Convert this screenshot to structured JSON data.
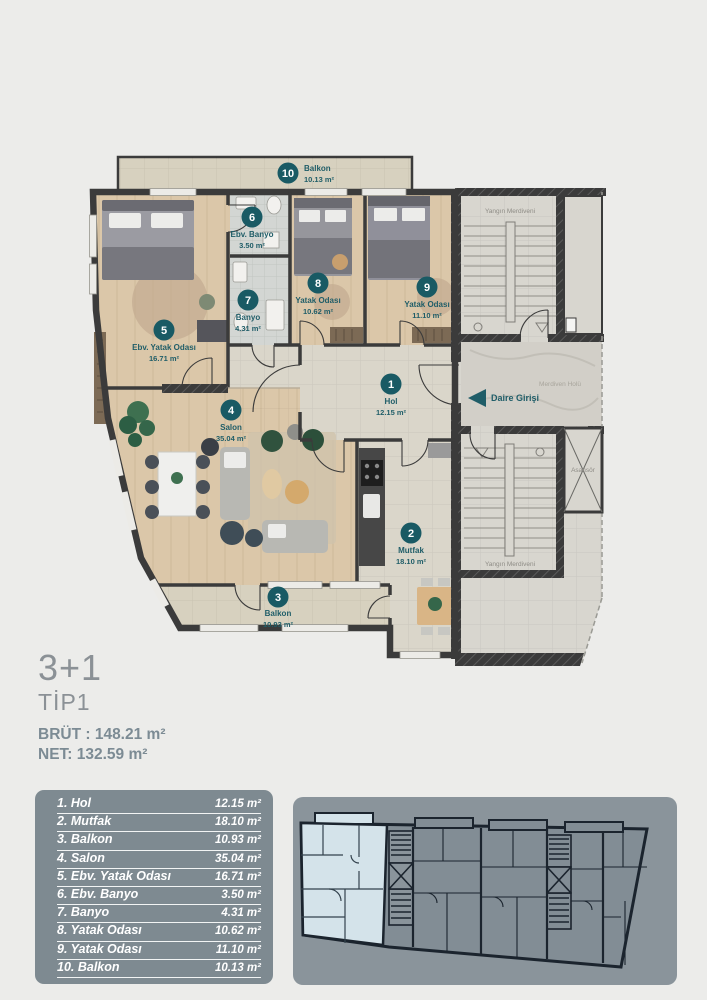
{
  "header": {
    "type_label": "3+1",
    "tip_label": "TİP1",
    "brut": "BRÜT : 148.21 m²",
    "net": "NET: 132.59 m²"
  },
  "floor_plan": {
    "rooms": [
      {
        "no": "1",
        "name": "Hol",
        "area": "12.15 m²"
      },
      {
        "no": "2",
        "name": "Mutfak",
        "area": "18.10 m²"
      },
      {
        "no": "3",
        "name": "Balkon",
        "area": "10.93 m²"
      },
      {
        "no": "4",
        "name": "Salon",
        "area": "35.04 m²"
      },
      {
        "no": "5",
        "name": "Ebv. Yatak Odası",
        "area": "16.71 m²"
      },
      {
        "no": "6",
        "name": "Ebv. Banyo",
        "area": "3.50 m²"
      },
      {
        "no": "7",
        "name": "Banyo",
        "area": "4.31 m²"
      },
      {
        "no": "8",
        "name": "Yatak Odası",
        "area": "10.62 m²"
      },
      {
        "no": "9",
        "name": "Yatak Odası",
        "area": "11.10 m²"
      },
      {
        "no": "10",
        "name": "Balkon",
        "area": "10.13 m²"
      }
    ],
    "annotations": {
      "fire_escape_top": "Yangın Merdiveni",
      "fire_escape_bottom": "Yangın Merdiveni",
      "stair_hall": "Merdiven Holü",
      "elevator": "Asansör",
      "entrance": "Daire Girişi"
    }
  },
  "area_table": {
    "rows": [
      {
        "label": "1. Hol",
        "value": "12.15 m²"
      },
      {
        "label": "2. Mutfak",
        "value": "18.10 m²"
      },
      {
        "label": "3. Balkon",
        "value": "10.93 m²"
      },
      {
        "label": "4. Salon",
        "value": "35.04 m²"
      },
      {
        "label": "5. Ebv. Yatak Odası",
        "value": "16.71 m²"
      },
      {
        "label": "6. Ebv. Banyo",
        "value": "3.50 m²"
      },
      {
        "label": "7. Banyo",
        "value": "4.31 m²"
      },
      {
        "label": "8. Yatak Odası",
        "value": "10.62 m²"
      },
      {
        "label": "9. Yatak Odası",
        "value": "11.10 m²"
      },
      {
        "label": "10. Balkon",
        "value": "10.13 m²"
      }
    ]
  },
  "colors": {
    "badge_teal": "#195A64",
    "label_teal": "#1F5D68",
    "wall": "#3B3B3B",
    "wood_floor": "#DBC7A9",
    "tile_floor": "#DAD6CA",
    "balcony_floor": "#D7D1BF",
    "table_card_bg": "#7E8A91",
    "keyplan_card_bg": "#8A949B",
    "keyplan_highlight": "#D4E3EA"
  }
}
